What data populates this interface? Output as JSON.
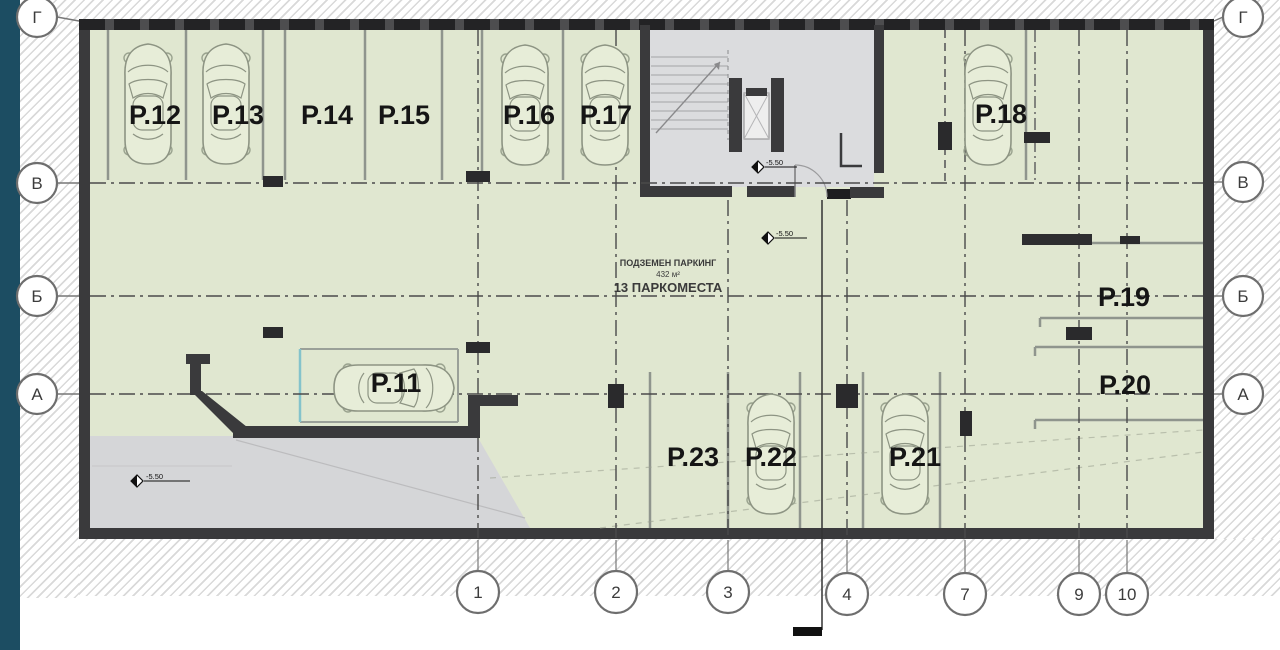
{
  "plan": {
    "area_label": {
      "line1": "ПОДЗЕМЕН ПАРКИНГ",
      "line2": "432 м²",
      "line3": "13 ПАРКОМЕСТА"
    },
    "level_marker": "-5.50",
    "spots": [
      {
        "id": "spot-p11",
        "label": "P.11",
        "has_car": true
      },
      {
        "id": "spot-p12",
        "label": "P.12",
        "has_car": true
      },
      {
        "id": "spot-p13",
        "label": "P.13",
        "has_car": true
      },
      {
        "id": "spot-p14",
        "label": "P.14",
        "has_car": false
      },
      {
        "id": "spot-p15",
        "label": "P.15",
        "has_car": false
      },
      {
        "id": "spot-p16",
        "label": "P.16",
        "has_car": true
      },
      {
        "id": "spot-p17",
        "label": "P.17",
        "has_car": true
      },
      {
        "id": "spot-p18",
        "label": "P.18",
        "has_car": true
      },
      {
        "id": "spot-p19",
        "label": "P.19",
        "has_car": false
      },
      {
        "id": "spot-p20",
        "label": "P.20",
        "has_car": false
      },
      {
        "id": "spot-p21",
        "label": "P.21",
        "has_car": true
      },
      {
        "id": "spot-p22",
        "label": "P.22",
        "has_car": true
      },
      {
        "id": "spot-p23",
        "label": "P.23",
        "has_car": false
      }
    ],
    "axes": {
      "rows": [
        {
          "label": "Г"
        },
        {
          "label": "В"
        },
        {
          "label": "Б"
        },
        {
          "label": "А"
        }
      ],
      "cols": [
        {
          "label": "1"
        },
        {
          "label": "2"
        },
        {
          "label": "3"
        },
        {
          "label": "4"
        },
        {
          "label": "7"
        },
        {
          "label": "9"
        },
        {
          "label": "10"
        }
      ]
    }
  },
  "colors": {
    "edge_strip": "#1c4d62",
    "wall": "#3a3a3c",
    "interior_green": "#e0e7d0",
    "stair_core_gray": "#dbdcde",
    "ramp_gray": "#d5d6d8",
    "divider_gray": "#8f958d",
    "axis_line": "#4a4a4a",
    "label_black": "#151515"
  }
}
